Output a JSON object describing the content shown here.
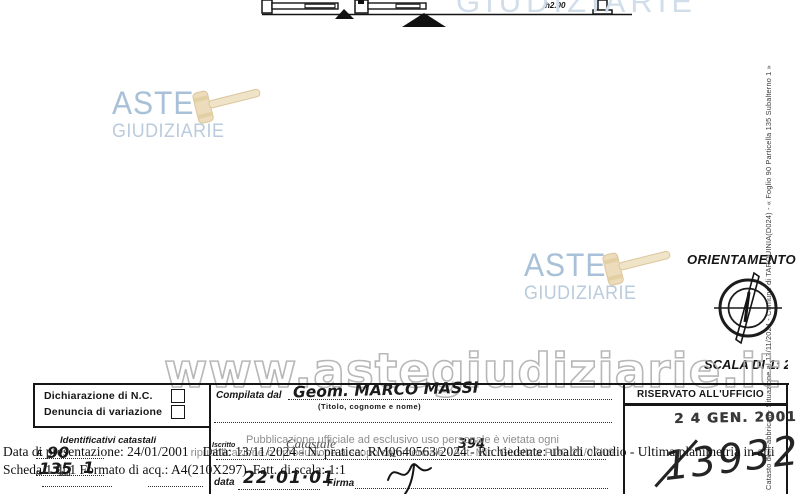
{
  "plan": {
    "height_annotation": "h2.00"
  },
  "side_note": {
    "text": "Catasto dei Fabbricati - Situazione al 13/11/2024 - Comune di TARQUINIA(D024) - « Foglio 90 Particella 135 Subalterno 1 »"
  },
  "watermarks": {
    "brand_top": "ASTE",
    "brand_bottom": "GIUDIZIARIE",
    "partial_top_right": "GIUDIZIARIE",
    "site_url": "www.astegiudiziarie.it",
    "disclaimer_line1": "Pubblicazione ufficiale ad esclusivo uso personale è vietata ogni",
    "disclaimer_line2": "ripubblicazione o riproduzione a scopo commerciale - Aut. Min. Giustizia PDG 21/07/09",
    "ghost_fragment": "Catastale"
  },
  "orientation": {
    "title": "ORIENTAMENTO",
    "scale": "SCALA DI 1: 20"
  },
  "form": {
    "declaration_nc": "Dichiarazione di N.C.",
    "declaration_var": "Denuncia di variazione",
    "identifiers_title": "Identificativi catastali",
    "foglio_label": "F.",
    "foglio_value": "90",
    "n_label": "n.",
    "particella_value": "135",
    "sub_label": "sub.",
    "sub_value": "1",
    "compiled_label": "Compilata dal",
    "compiled_value": "Geom. MARCO MASSI",
    "compiled_hint": "(Titolo, cognome e nome)",
    "enrolled_label": "Iscritto",
    "enrolled_n_label": "n.",
    "enrolled_number": "394",
    "date_label": "data",
    "date_value": "22·01·01",
    "signature_label": "Firma",
    "office_header": "RISERVATO ALL'UFFICIO",
    "office_stamp": "2 4 GEN. 2001",
    "office_number": "13932"
  },
  "footer": {
    "presentation": "Data di presentazione: 24/01/2001",
    "request": "Data: 13/11/2024 - N. pratica: RM0640563/2024 - Richiedente: ubaldi claudio - Ultima planimetria in atti",
    "sheet": "Scheda 1 di 1 Formato di acq.: A4(210X297)",
    "scale_factor": "Fatt. di scala: 1:1"
  }
}
